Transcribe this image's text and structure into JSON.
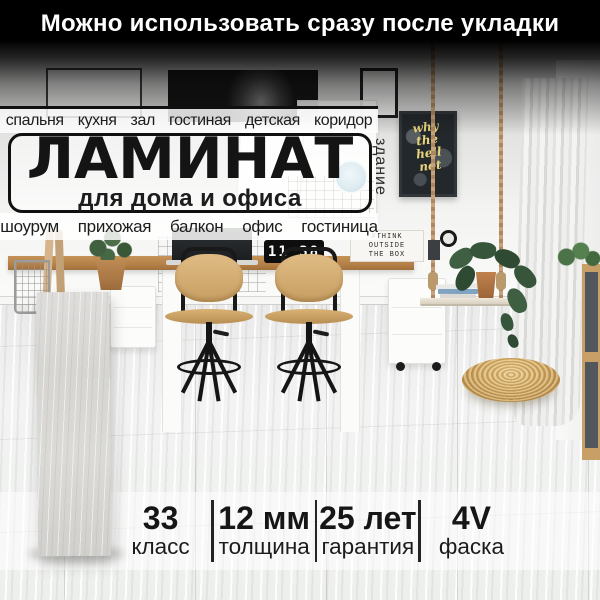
{
  "banner": {
    "text": "Можно использовать сразу после укладки"
  },
  "overlay": {
    "rooms_top": "спальня  кухня  зал  гостиная  детская  коридор",
    "title": "ЛАМИНАТ",
    "subtitle": "для дома и офиса",
    "vertical_label": "здание",
    "rooms_bottom": "шоурум  прихожая  балкон  офис  гостиница"
  },
  "specs": [
    {
      "value": "33",
      "label": "класс"
    },
    {
      "value": "12 мм",
      "label": "толщина"
    },
    {
      "value": "25 лет",
      "label": "гарантия"
    },
    {
      "value": "4V",
      "label": "фаска"
    }
  ],
  "scene": {
    "clock_time": "11 38",
    "lightbox_lines": [
      "#THINK",
      "OUTSIDE",
      "THE BOX"
    ],
    "poster_lines": [
      "why",
      "the",
      "hell",
      "not"
    ],
    "colors": {
      "banner_bg": "#000000",
      "banner_text": "#ffffff",
      "overlay_text": "#141414",
      "box_border": "#101010",
      "poster_bg": "#23282c",
      "poster_text": "#e9d57e",
      "desk_wood": "#b5824a",
      "pouf_wicker": "#cfa258",
      "floor": "#edefed",
      "plank_sample": "#d6d5d1"
    }
  }
}
